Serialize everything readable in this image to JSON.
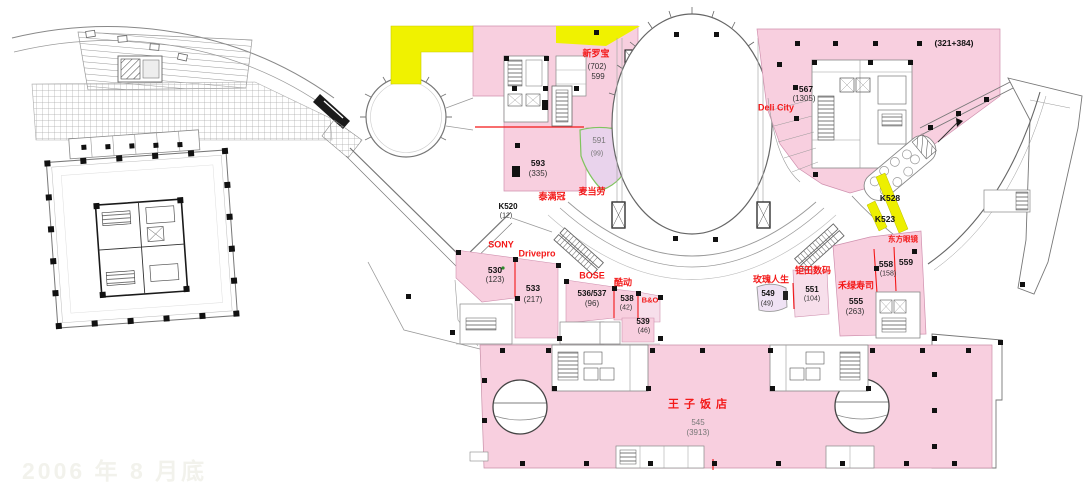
{
  "watermark": {
    "text": "2006 年 8 月底"
  },
  "palette": {
    "pink": "#F8CFDF",
    "lavender": "#E9D3EC",
    "lavender2": "#EFE2F4",
    "pink_light": "#F7DFEB",
    "yellow": "#F0F200",
    "red": "#F31818",
    "green_border": "#7FC45E"
  },
  "shops": {
    "xinluobao": {
      "name": "新罗宝",
      "unit": "(702)",
      "area": "599"
    },
    "u593": {
      "unit": "593",
      "area": "(335)"
    },
    "u591": {
      "unit": "591",
      "area": "(99)"
    },
    "taimanguan": {
      "name": "泰满冠"
    },
    "mcdonalds": {
      "name": "麦当劳"
    },
    "k520": {
      "unit": "K520",
      "area": "(12)"
    },
    "sony": {
      "name": "SONY"
    },
    "drivepro": {
      "name": "Drivepro"
    },
    "u530": {
      "unit": "530",
      "area": "(123)"
    },
    "u533": {
      "unit": "533",
      "area": "(217)"
    },
    "bose": {
      "name": "BOSE"
    },
    "u536_537": {
      "unit": "536/537",
      "area": "(96)"
    },
    "kudong": {
      "name": "酷动"
    },
    "u538": {
      "unit": "538",
      "area": "(42)"
    },
    "bo": {
      "name": "B&O"
    },
    "u539": {
      "unit": "539",
      "area": "(46)"
    },
    "meiguirensheng": {
      "name": "玫瑰人生"
    },
    "u549": {
      "unit": "549",
      "area": "(49)"
    },
    "jutianshuma": {
      "name": "钜田数码"
    },
    "u551": {
      "unit": "551",
      "area": "(104)"
    },
    "helüshousi": {
      "name": "禾绿寿司"
    },
    "u555": {
      "unit": "555",
      "area": "(263)"
    },
    "u558": {
      "unit": "558",
      "area": "(158)"
    },
    "u559": {
      "unit": "559"
    },
    "dongfangyanjing": {
      "name": "东方眼镜"
    },
    "k528": {
      "unit": "K528"
    },
    "k523": {
      "unit": "K523"
    },
    "u567": {
      "unit": "567",
      "area": "(1305)"
    },
    "delicity": {
      "name": "Deli City"
    },
    "band": {
      "area": "(321+384)"
    },
    "princehotel": {
      "name": "王子饭店",
      "unit": "545",
      "area": "(3913)"
    }
  }
}
